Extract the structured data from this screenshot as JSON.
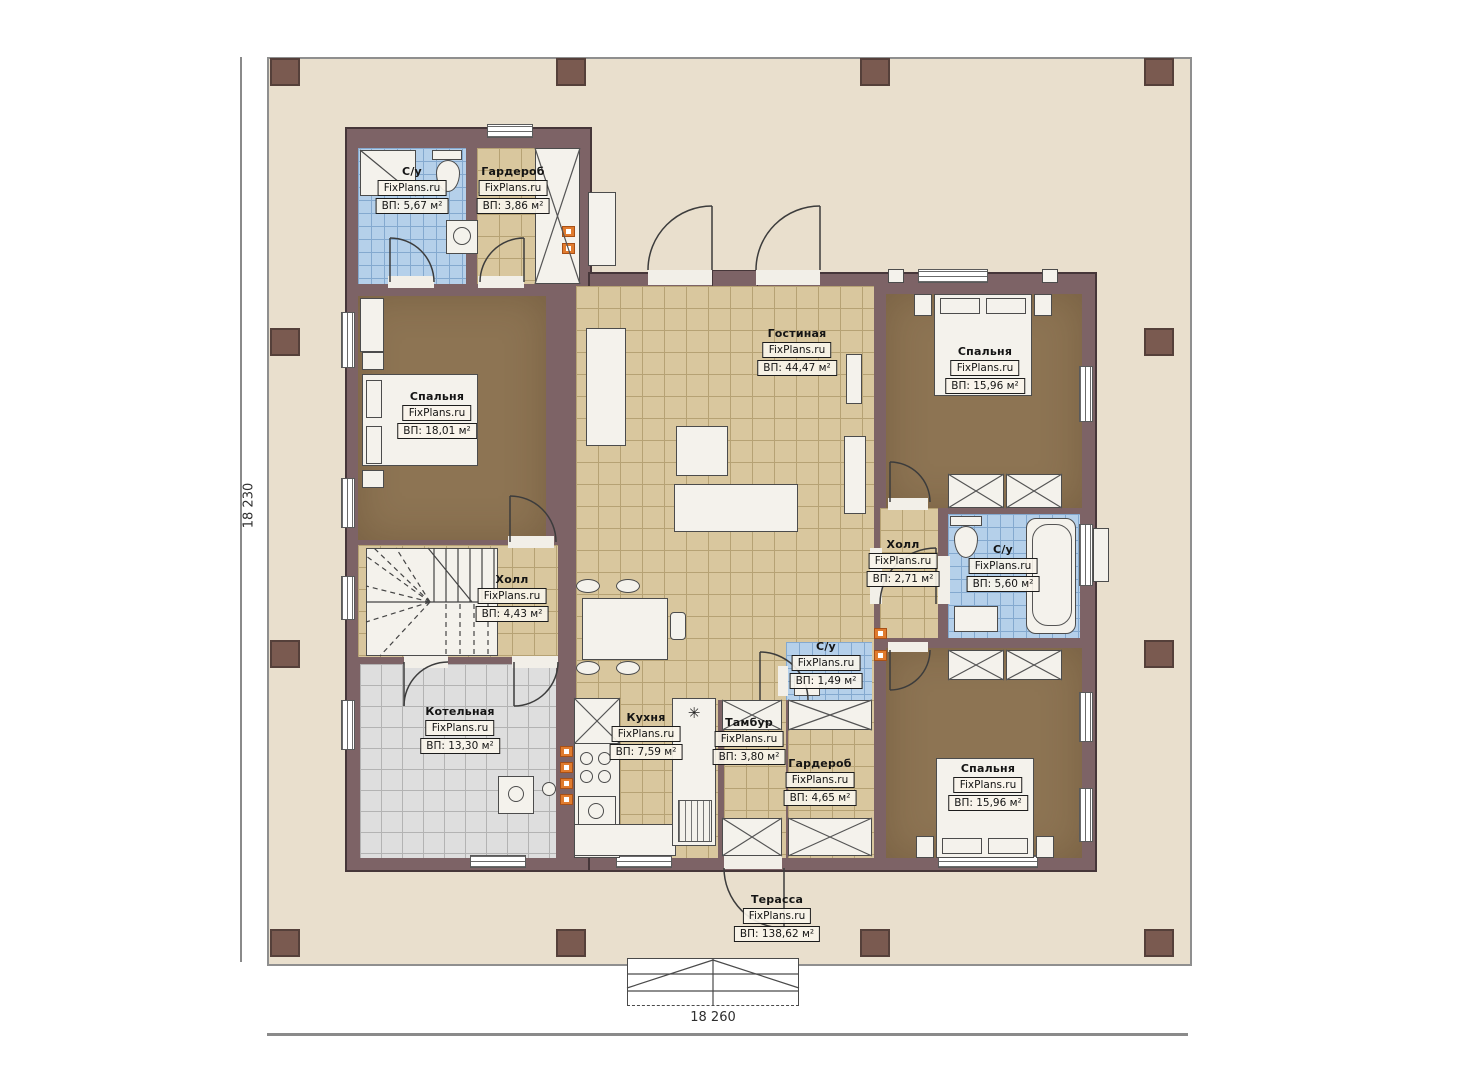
{
  "plan": {
    "brand": "FixPlans.ru",
    "dimensions": {
      "left": "18 230",
      "bottom": "18 260"
    },
    "icons": {
      "snowflake": "✳"
    },
    "colors": {
      "wall": "#7d6366",
      "terrace": "#e9dfcd",
      "tile_tan": "#d9c79e",
      "tile_blue": "#b5d0ea",
      "tile_gray": "#dedede",
      "floor_brown": "#8d7453",
      "vent_orange": "#e07b2e"
    },
    "rooms": [
      {
        "name": "С/у",
        "area": "ВП: 5,67 м²"
      },
      {
        "name": "Гардероб",
        "area": "ВП: 3,86 м²"
      },
      {
        "name": "Спальня",
        "area": "ВП: 18,01 м²"
      },
      {
        "name": "Гостиная",
        "area": "ВП: 44,47 м²"
      },
      {
        "name": "Спальня",
        "area": "ВП: 15,96 м²"
      },
      {
        "name": "Холл",
        "area": "ВП: 2,71 м²"
      },
      {
        "name": "С/у",
        "area": "ВП: 5,60 м²"
      },
      {
        "name": "Холл",
        "area": "ВП: 4,43 м²"
      },
      {
        "name": "С/у",
        "area": "ВП: 1,49 м²"
      },
      {
        "name": "Котельная",
        "area": "ВП: 13,30 м²"
      },
      {
        "name": "Кухня",
        "area": "ВП: 7,59 м²"
      },
      {
        "name": "Тамбур",
        "area": "ВП: 3,80 м²"
      },
      {
        "name": "Гардероб",
        "area": "ВП: 4,65 м²"
      },
      {
        "name": "Спальня",
        "area": "ВП: 15,96 м²"
      },
      {
        "name": "Терасса",
        "area": "ВП: 138,62 м²"
      }
    ]
  }
}
